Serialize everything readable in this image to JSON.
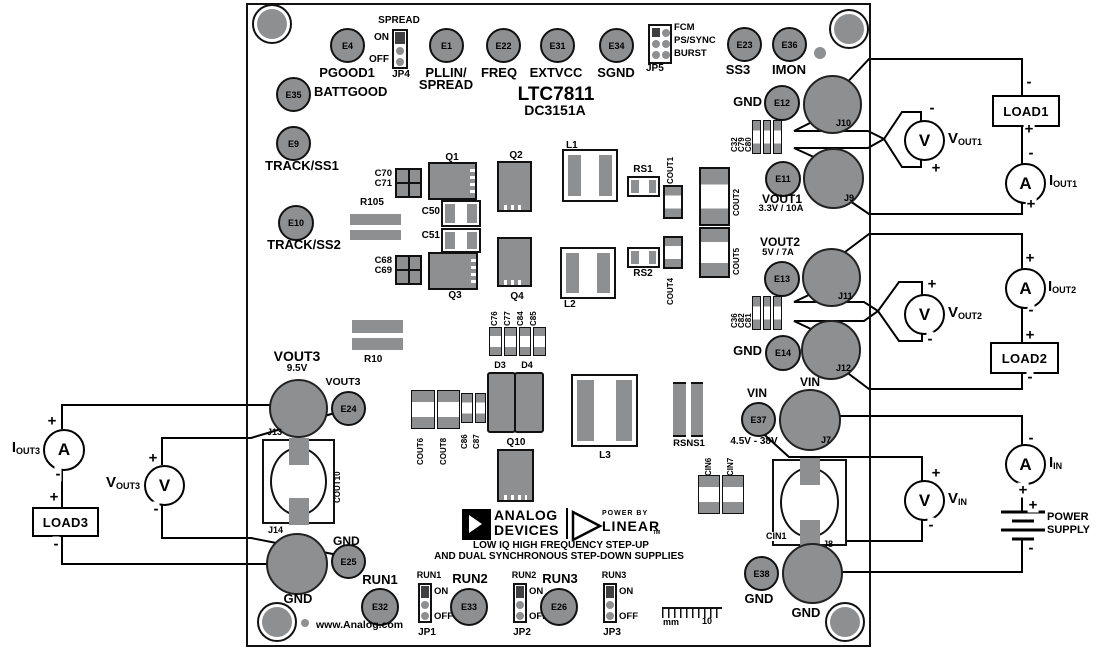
{
  "board": {
    "title": "LTC7811",
    "subtitle": "DC3151A",
    "website": "www.Analog.com",
    "tagline1": "LOW IQ HIGH FREQUENCY STEP-UP",
    "tagline2": "AND DUAL SYNCHRONOUS STEP-DOWN SUPPLIES",
    "ruler_unit": "mm",
    "ruler_max": "10",
    "logo": {
      "brand1": "ANALOG",
      "brand2": "DEVICES",
      "power_by": "POWER BY",
      "linear": "LINEAR",
      "tm": "TM"
    }
  },
  "colors": {
    "pad_gray": "#8d8f91",
    "shunt_dark": "#3f3f42",
    "outline": "#111111"
  },
  "test_points": {
    "e1": "E1",
    "e4": "E4",
    "e9": "E9",
    "e10": "E10",
    "e11": "E11",
    "e12": "E12",
    "e13": "E13",
    "e14": "E14",
    "e22": "E22",
    "e23": "E23",
    "e24": "E24",
    "e25": "E25",
    "e26": "E26",
    "e31": "E31",
    "e32": "E32",
    "e33": "E33",
    "e34": "E34",
    "e35": "E35",
    "e36": "E36",
    "e37": "E37",
    "e38": "E38"
  },
  "tp_labels": {
    "pgood1": "PGOOD1",
    "battgood": "BATTGOOD",
    "pllin_line1": "PLLIN/",
    "pllin_line2": "SPREAD",
    "freq": "FREQ",
    "extvcc": "EXTVCC",
    "sgnd": "SGND",
    "ss3": "SS3",
    "imon": "IMON",
    "track_ss1": "TRACK/SS1",
    "track_ss2": "TRACK/SS2",
    "run1": "RUN1",
    "run2": "RUN2",
    "run3": "RUN3"
  },
  "jumpers": {
    "jp4": {
      "name": "JP4",
      "label": "SPREAD",
      "on": "ON",
      "off": "OFF"
    },
    "jp5": {
      "name": "JP5",
      "opt1": "FCM",
      "opt2": "PS/SYNC",
      "opt3": "BURST"
    },
    "jp1": {
      "name": "JP1",
      "label": "RUN1",
      "on": "ON",
      "off": "OFF"
    },
    "jp2": {
      "name": "JP2",
      "label": "RUN2",
      "on": "ON",
      "off": "OFF"
    },
    "jp3": {
      "name": "JP3",
      "label": "RUN3",
      "on": "ON",
      "off": "OFF"
    }
  },
  "connectors": {
    "j7": "J7",
    "j8": "J8",
    "j9": "J9",
    "j10": "J10",
    "j11": "J11",
    "j12": "J12",
    "j13": "J13",
    "j14": "J14"
  },
  "labels": {
    "gnd": "GND",
    "vin": "VIN",
    "vout1": "VOUT1",
    "vout1_rating": "3.3V / 10A",
    "vout2": "VOUT2",
    "vout2_rating": "5V / 7A",
    "vout3": "VOUT3",
    "vout3_rating": "9.5V",
    "vin_range": "4.5V - 38V"
  },
  "components": {
    "q1": "Q1",
    "q2": "Q2",
    "q3": "Q3",
    "q4": "Q4",
    "q10": "Q10",
    "d3": "D3",
    "d4": "D4",
    "l1": "L1",
    "l2": "L2",
    "l3": "L3",
    "r10": "R10",
    "r105": "R105",
    "rs1": "RS1",
    "rs2": "RS2",
    "rsns1": "RSNS1",
    "c50": "C50",
    "c51": "C51",
    "c68": "C68",
    "c69": "C69",
    "c70": "C70",
    "c71": "C71",
    "c76": "C76",
    "c77": "C77",
    "c84": "C84",
    "c85": "C85",
    "c86": "C86",
    "c87": "C87",
    "c32": "C32",
    "c79": "C79",
    "c80": "C80",
    "c36": "C36",
    "c82": "C82",
    "c81": "C81",
    "cout1": "COUT1",
    "cout2": "COUT2",
    "cout4": "COUT4",
    "cout5": "COUT5",
    "cout6": "COUT6",
    "cout8": "COUT8",
    "cout10": "COUT10",
    "cin1": "CIN1",
    "cin6": "CIN6",
    "cin7": "CIN7"
  },
  "sch": {
    "plus": "+",
    "minus": "-",
    "load1": "LOAD1",
    "load2": "LOAD2",
    "load3": "LOAD3",
    "power1": "POWER",
    "power2": "SUPPLY",
    "meters": {
      "vout1": {
        "sym": "V",
        "m": "V",
        "s": "OUT1"
      },
      "iout1": {
        "sym": "A",
        "m": "I",
        "s": "OUT1"
      },
      "vout2": {
        "sym": "V",
        "m": "V",
        "s": "OUT2"
      },
      "iout2": {
        "sym": "A",
        "m": "I",
        "s": "OUT2"
      },
      "vin": {
        "sym": "V",
        "m": "V",
        "s": "IN"
      },
      "iin": {
        "sym": "A",
        "m": "I",
        "s": "IN"
      },
      "vout3": {
        "sym": "V",
        "m": "V",
        "s": "OUT3"
      },
      "iout3": {
        "sym": "A",
        "m": "I",
        "s": "OUT3"
      }
    }
  }
}
